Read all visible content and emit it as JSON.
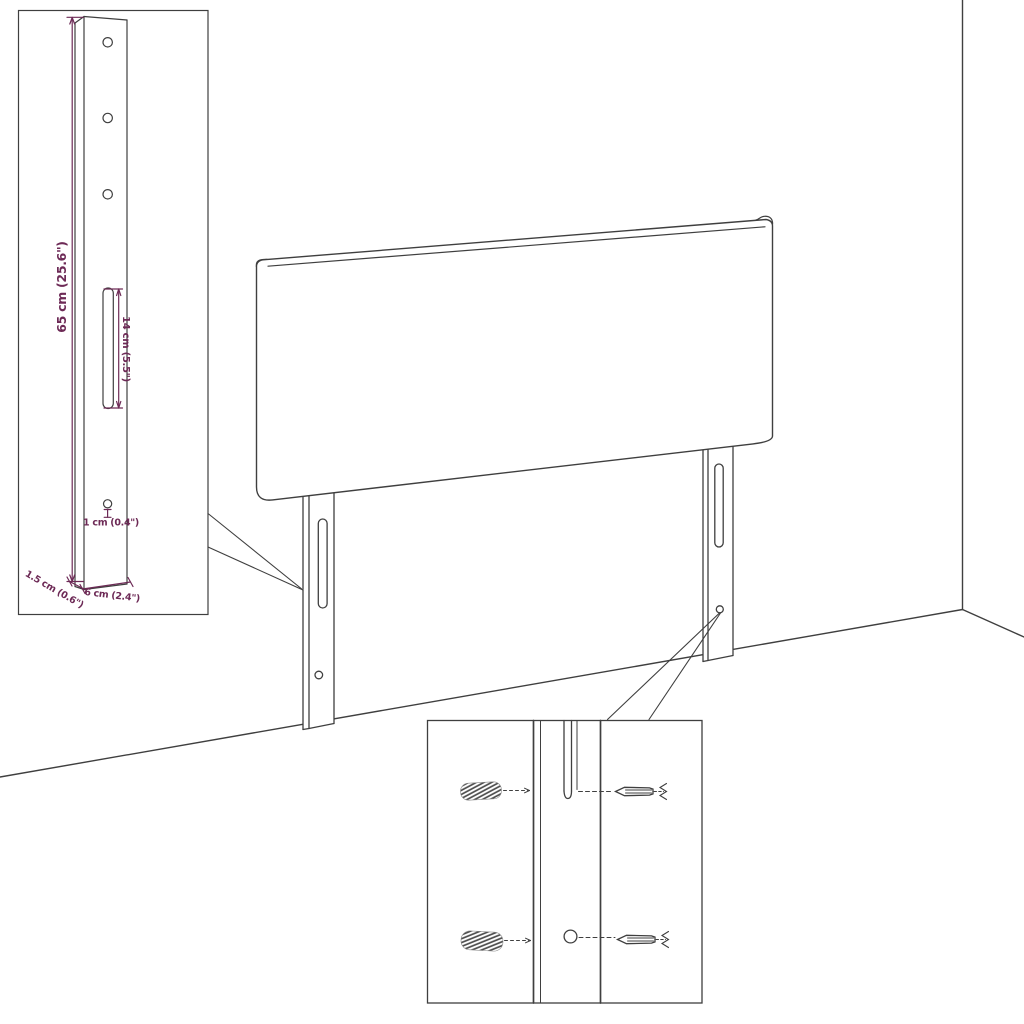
{
  "diagram": {
    "annotation_color": "#6d2a56",
    "line_color": "#3f3f3f",
    "labels": {
      "leg_height": "65 cm (25.6\")",
      "slot_length": "14 cm (5.5\")",
      "hole_diameter": "1 cm (0.4\")",
      "leg_thickness": "1.5 cm (0.6\")",
      "leg_width": "6 cm (2.4\")"
    }
  }
}
